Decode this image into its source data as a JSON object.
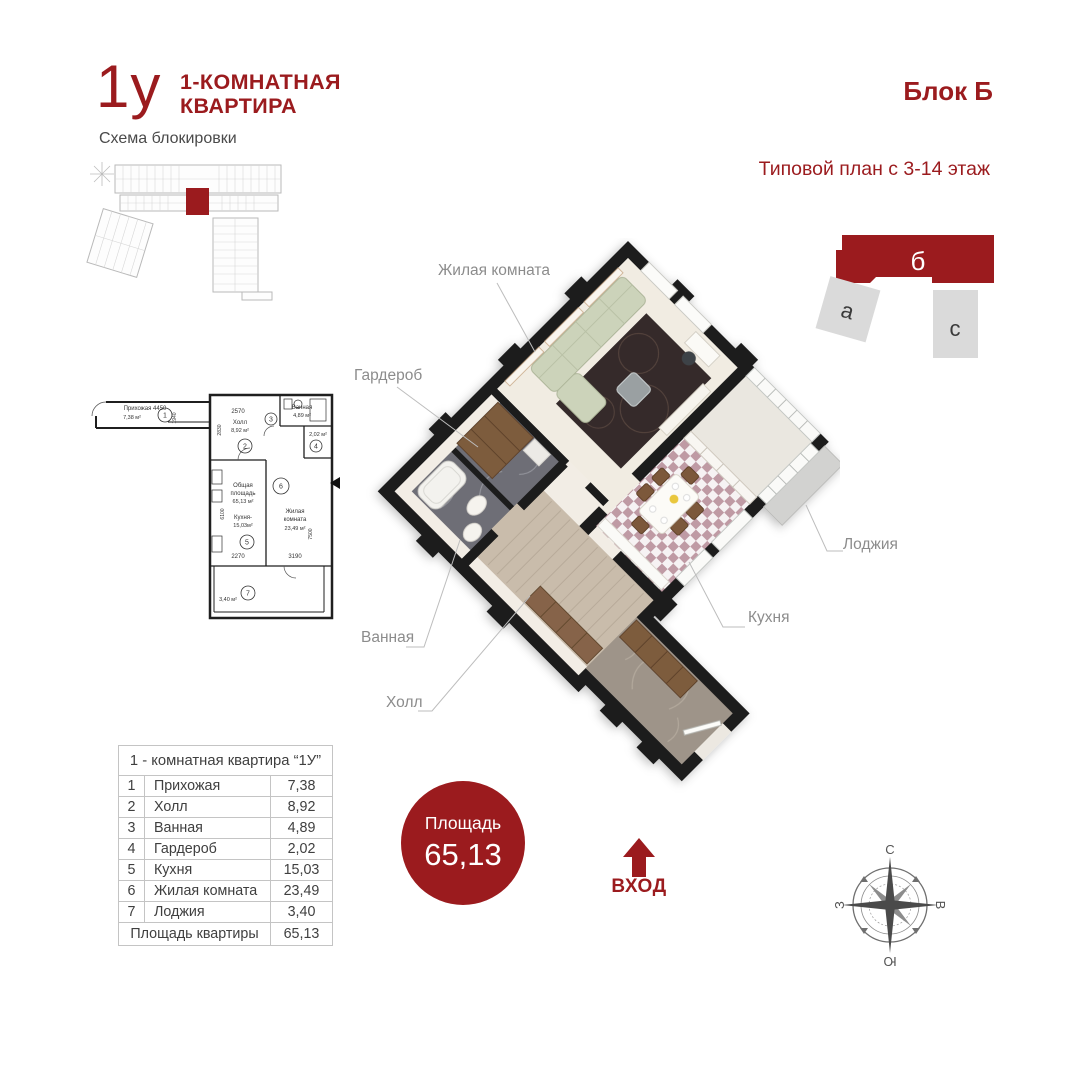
{
  "header": {
    "logo": "1у",
    "type_line1": "1-КОМНАТНАЯ",
    "type_line2": "КВАРТИРА",
    "scheme_label": "Схема блокировки",
    "block_title": "Блок Б",
    "subtitle": "Типовой план с 3-14 этаж"
  },
  "block_diagram": {
    "block_b": "б",
    "block_a": "а",
    "block_c": "с"
  },
  "plan_labels": {
    "living": "Жилая комната",
    "wardrobe": "Гардероб",
    "bath": "Ванная",
    "hall": "Холл",
    "kitchen": "Кухня",
    "loggia": "Лоджия"
  },
  "area_badge": {
    "label": "Площадь",
    "value": "65,13"
  },
  "entrance_label": "ВХОД",
  "compass": {
    "n": "С",
    "e": "В",
    "s": "Ю",
    "w": "З"
  },
  "table": {
    "title": "1 - комнатная квартира “1У”",
    "rows": [
      {
        "num": "1",
        "name": "Прихожая",
        "area": "7,38"
      },
      {
        "num": "2",
        "name": "Холл",
        "area": "8,92"
      },
      {
        "num": "3",
        "name": "Ванная",
        "area": "4,89"
      },
      {
        "num": "4",
        "name": "Гардероб",
        "area": "2,02"
      },
      {
        "num": "5",
        "name": "Кухня",
        "area": "15,03"
      },
      {
        "num": "6",
        "name": "Жилая комната",
        "area": "23,49"
      },
      {
        "num": "7",
        "name": "Лоджия",
        "area": "3,40"
      }
    ],
    "total_label": "Площадь квартиры",
    "total_value": "65,13"
  },
  "plan2d": {
    "entry_label": "Прихожая 4450",
    "entry_area": "7,38 м²",
    "dim_entry_v": "1940",
    "dim_top": "2570",
    "dim_top_v": "2830",
    "hall_label": "Холл",
    "hall_area": "8,92 м²",
    "bath_label": "Ванная",
    "bath_area": "4,89 м²",
    "wardrobe_area": "2,02 м²",
    "total_line1": "Общая",
    "total_line2": "площадь",
    "total_line3": "65,13 м²",
    "kitchen_label": "Кухня-",
    "kitchen_area": "15,03м²",
    "living_line1": "Жилая",
    "living_line2": "комната",
    "living_area": "23,49 м²",
    "loggia_area": "3,40 м²",
    "dim_kitchen": "2270",
    "dim_living": "3190",
    "dim_right_v": "7500",
    "dim_left_v": "6100",
    "num1": "1",
    "num2": "2",
    "num3": "3",
    "num4": "4",
    "num5": "5",
    "num6": "6",
    "num7": "7"
  },
  "colors": {
    "accent": "#9b1b1e",
    "label_gray": "#8c8c8c",
    "table_text": "#3f3f3f"
  }
}
